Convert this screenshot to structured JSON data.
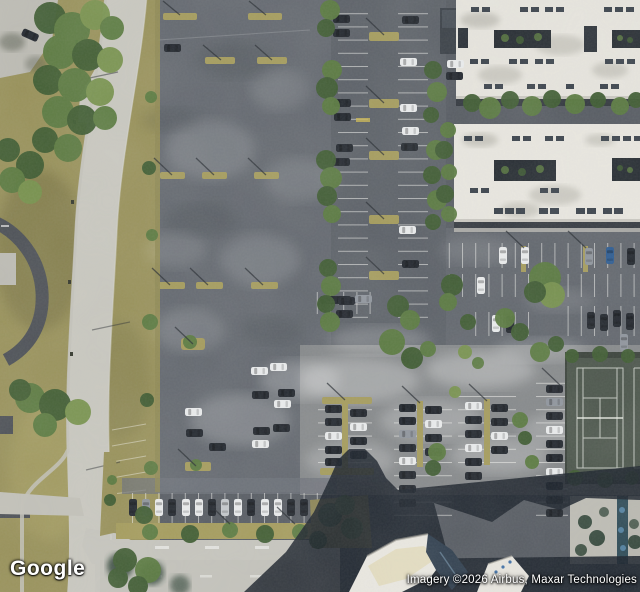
{
  "map": {
    "provider_logo": "Google",
    "attribution": "Imagery ©2026 Airbus, Maxar Technologies",
    "view_type": "satellite"
  },
  "colors": {
    "asphalt": "#565b62",
    "parking_lot": "#63686f",
    "sunlit_pavement": "#85888a",
    "road_concrete": "#c8c7bf",
    "grass": "#98915a",
    "tree_dark": "#3f5c32",
    "tree_mid": "#5a7a40",
    "building_roof": "#e7e5de",
    "shadow": "#1b222b",
    "tennis_court": "#4b554b",
    "car_white": "#ebedee",
    "car_dark": "#22272e",
    "car_blue": "#2d5c92",
    "island_grass": "#a49b5c"
  }
}
